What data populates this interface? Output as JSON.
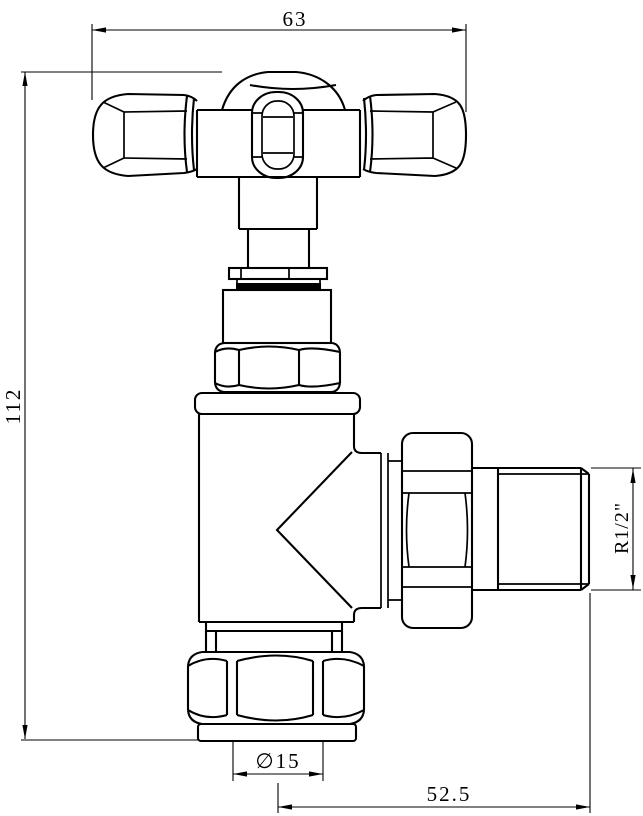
{
  "drawing": {
    "labels": {
      "width": "63",
      "height": "112",
      "thread": "R1/2\"",
      "diameter": "∅15",
      "offset": "52.5"
    },
    "colors": {
      "line": "#000000",
      "background": "#ffffff"
    }
  }
}
